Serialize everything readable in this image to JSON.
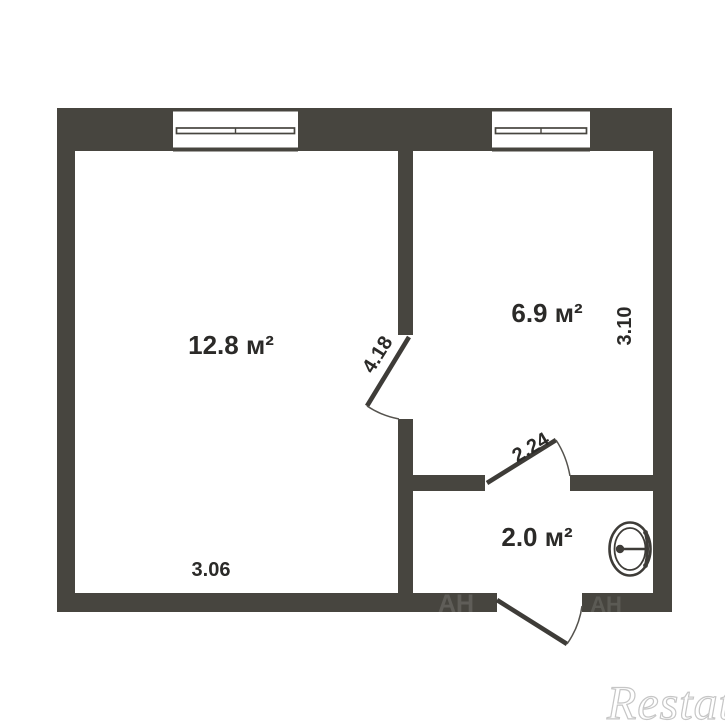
{
  "floor_plan": {
    "rooms": [
      {
        "label": "12.8 м²"
      },
      {
        "label": "6.9 м²"
      },
      {
        "label": "2.0 м²"
      }
    ],
    "dimensions": {
      "left_room_height": "4.18",
      "right_room_height": "3.10",
      "hall_width": "2.24",
      "left_room_width": "3.06"
    },
    "fixtures": [
      {
        "icon": "toilet-icon"
      }
    ],
    "watermark": {
      "brand": "Restate",
      "wall_marks": "АН"
    },
    "colors": {
      "wall": "#47453F",
      "door_line": "#3E3C38",
      "text": "#2B2A28",
      "background": "#FFFFFF",
      "watermark_gray": "#C6C6C6"
    }
  }
}
